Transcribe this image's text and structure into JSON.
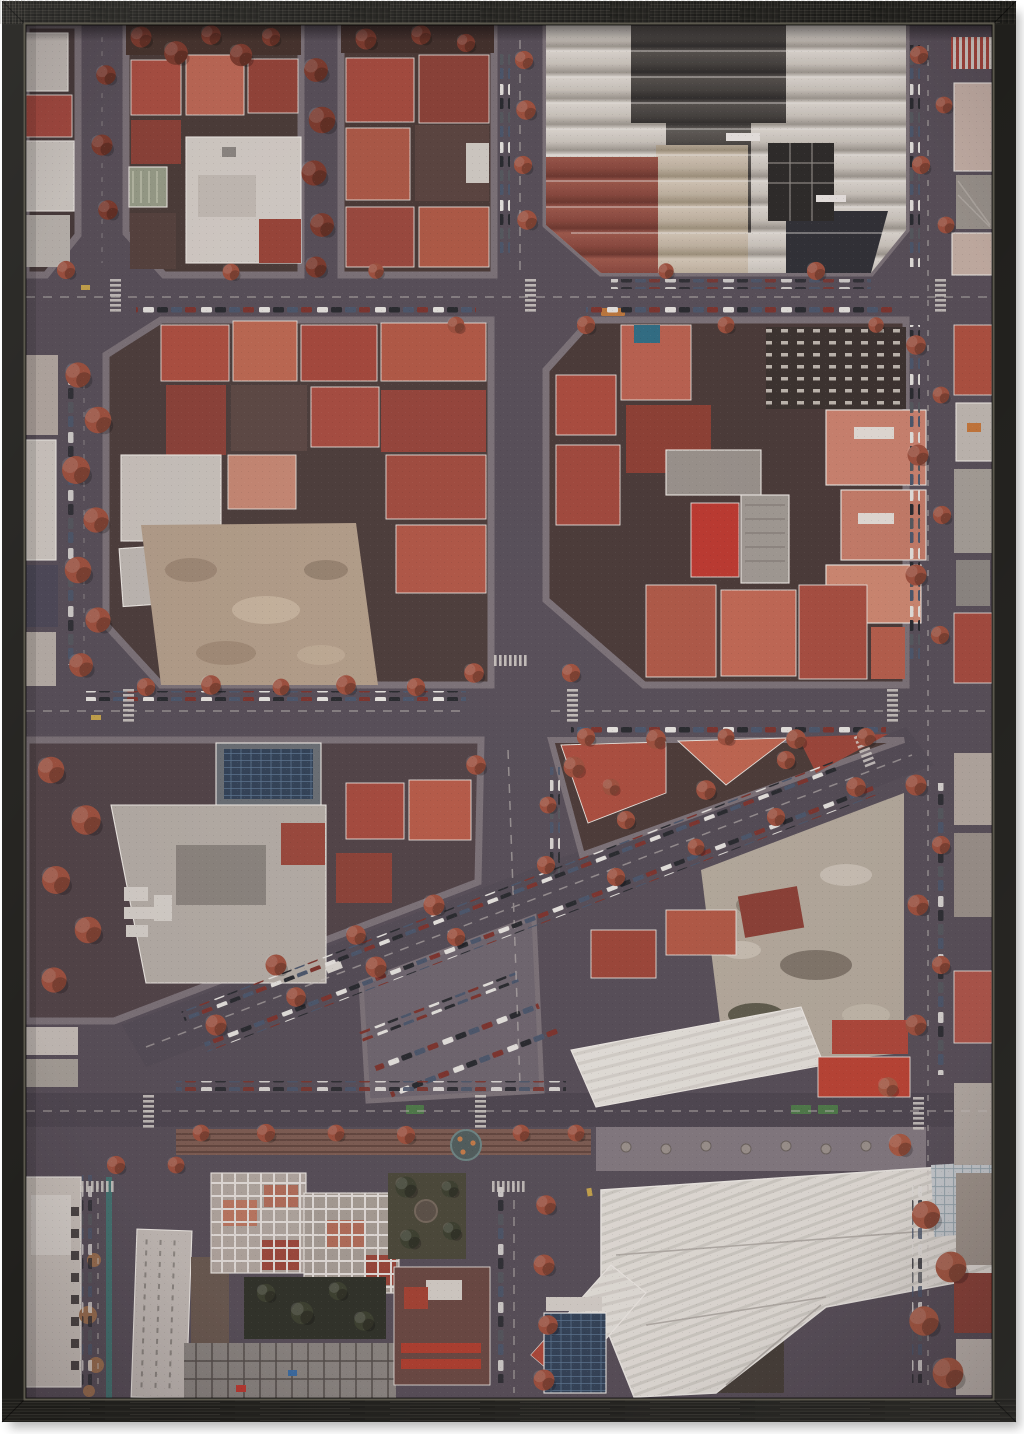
{
  "canvas": {
    "width": 1024,
    "height": 1434
  },
  "artwork": {
    "kind": "framed poster, aerial photograph",
    "subject": "Top-down drone view of dense city blocks with red rooftops, chamfered octagonal blocks, tree-lined streets, a diagonal avenue, a sawtooth-roof factory at top right and a large white warehouse at bottom right",
    "orientation": "portrait",
    "frame": {
      "material": "black stained wood grain",
      "material_color": "#201f1c",
      "bevel_color": "#5b584d",
      "mat_color": "#ffffff",
      "shadow_color": "#2a2a2a"
    },
    "photo": {
      "palette": {
        "asphalt": "#575059",
        "asphalt_dark": "#4e4851",
        "sidewalk": "#7d747a",
        "block_ground": "#453a39",
        "roof_red": "#a8493c",
        "roof_red_light": "#c06a52",
        "roof_salmon": "#cf8870",
        "roof_dark_red": "#7e3a30",
        "roof_white": "#d8d3cb",
        "roof_gray": "#a7a19b",
        "roof_charcoal": "#3c3a38",
        "factory_light": "#d9d5cc",
        "warehouse_white": "#e7e4dd",
        "tree_red": "#a0523e",
        "tree_red_dark": "#7e3b2c",
        "tree_olive": "#3c4130",
        "dirt": "#b5a18c",
        "rubble": "#b7ae9f",
        "solar_blue": "#324358",
        "car_white": "#e9e7e2",
        "car_dark": "#272a2f",
        "car_blue": "#4b586d",
        "car_red": "#7e352d",
        "road_marking": "#cdc8c2",
        "bike_green": "#4e7d4a",
        "teal_lane": "#3e7d77",
        "median_brown": "#7f5f53"
      },
      "landmarks": [
        "sawtooth factory roof, top right",
        "white courtyard building, top left block",
        "central four-way intersection with zebra crossing",
        "vacant dirt lot, middle left block",
        "rubble demolition lot beside diagonal avenue",
        "diagonal avenue with angled parking",
        "boulevard with tram median and circular playground",
        "large white warehouse roof, bottom right",
        "rooftop solar panels",
        "construction site, bottom left",
        "red autumn street trees"
      ]
    }
  }
}
